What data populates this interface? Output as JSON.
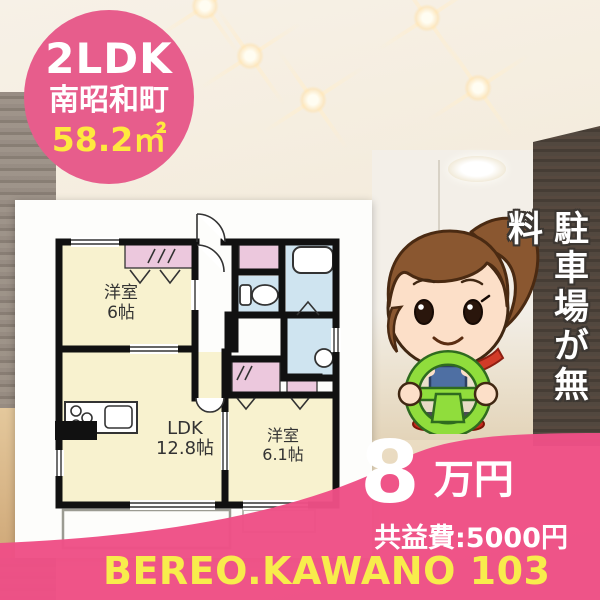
{
  "badge": {
    "layout": "2LDK",
    "town": "南昭和町",
    "area": "58.2㎡"
  },
  "floorplan": {
    "room1_name": "洋室",
    "room1_size": "6帖",
    "ldk_name": "LDK",
    "ldk_size": "12.8帖",
    "room2_name": "洋室",
    "room2_size": "6.1帖"
  },
  "side_banner": {
    "text": "駐車場が無料"
  },
  "price": {
    "amount": "8",
    "unit": "万円",
    "common_fee": "共益費:5000円"
  },
  "footer": {
    "property_name": "BEREO.KAWANO 103"
  },
  "colors": {
    "badge_pink": "#e75d8c",
    "accent_pink": "#ee4f86",
    "highlight_yellow": "#ffe93e",
    "plan_room_cream": "#f8f2cf",
    "plan_closet_pink": "#ecc8dd",
    "plan_wet_blue": "#cfe4f0",
    "wheel_green": "#90dd3c"
  }
}
